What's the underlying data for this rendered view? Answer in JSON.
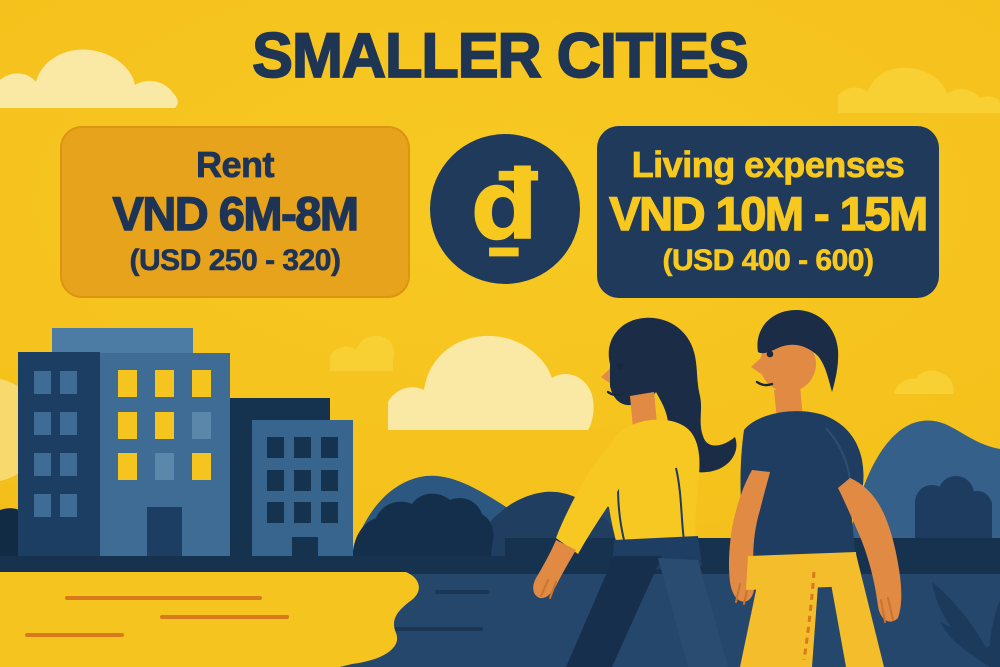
{
  "title": "SMALLER CITIES",
  "cards": {
    "rent": {
      "label": "Rent",
      "vnd": "VND 6M-8M",
      "usd": "(USD 250 - 320)"
    },
    "living": {
      "label": "Living expenses",
      "vnd": "VND 10M - 15M",
      "usd": "(USD 400 - 600)"
    }
  },
  "currency_badge": {
    "symbol": "₫"
  },
  "colors": {
    "background_gold": "#F5C11C",
    "navy_text": "#1E3553",
    "rent_card_bg": "#E8A31C",
    "living_card_bg": "#203A5C",
    "accent_yellow": "#F7C91F",
    "cream_cloud": "#FAE9A5",
    "building_blue": "#3E6C94",
    "water_navy": "#26476C",
    "skin_tone": "#E08A43"
  },
  "scene_elements": {
    "left": "city-buildings",
    "center": "clouds-and-mountains",
    "right": "couple-walking-by-water"
  }
}
